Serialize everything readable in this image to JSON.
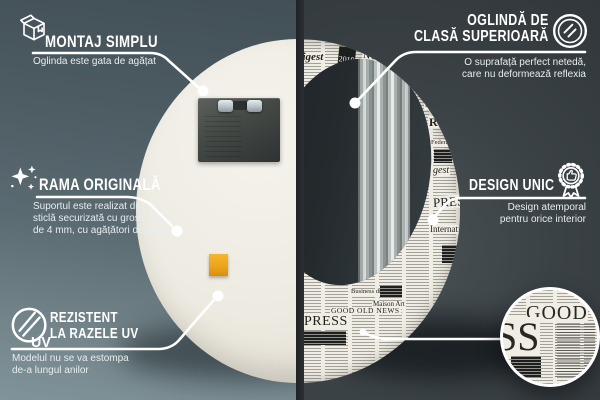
{
  "callouts": {
    "montaj": {
      "icon": "package-box-icon",
      "title": "MONTAJ SIMPLU",
      "subtitle": "Oglinda este gata de agățat"
    },
    "premium": {
      "icon": "mirror-icon",
      "title_lines": [
        "OGLINDĂ DE",
        "CLASĂ SUPERIOARĂ"
      ],
      "subtitle_lines": [
        "O suprafață perfect netedă,",
        "care nu deformează reflexia"
      ]
    },
    "rama": {
      "icon": "sparkles-icon",
      "title": "RAMA ORIGINALĂ",
      "subtitle_lines": [
        "Suportul este realizat din",
        "sticlă securizată cu grosimea",
        "de 4 mm, cu agățători dedicate"
      ]
    },
    "design": {
      "icon": "award-badge-icon",
      "title": "DESIGN UNIC",
      "subtitle_lines": [
        "Design atemporal",
        "pentru orice interior"
      ]
    },
    "uv": {
      "icon": "uv-circle-icon",
      "icon_text": "UV",
      "title_lines": [
        "REZISTENT",
        "LA RAZELE UV"
      ],
      "subtitle_lines": [
        "Modelul nu se va estompa",
        "de-a lungul anilor"
      ]
    }
  },
  "mirror_front": {
    "news_fragments": [
      {
        "text": "digest"
      },
      {
        "text": "2019"
      },
      {
        "text": "NEWS"
      },
      {
        "text": "arist"
      },
      {
        "text": "Internatio"
      },
      {
        "text": "R"
      },
      {
        "text": "Federal anal"
      },
      {
        "text": "gest"
      },
      {
        "text": "PRESS"
      },
      {
        "text": "Internation"
      },
      {
        "text": "Business dig"
      },
      {
        "text": "Maison Art"
      },
      {
        "text": "GOOD OLD NEWS"
      },
      {
        "text": "PRESS"
      }
    ]
  },
  "detail_circle": {
    "big_word": "GOOD",
    "huge_word": "SS"
  },
  "colors": {
    "left_wall": "#55636b",
    "right_wall": "#33393c",
    "newsprint": "#f0ede4",
    "sticker_orange": "#eca51c",
    "line_white": "#ffffff",
    "back_panel": "#edeae1"
  }
}
